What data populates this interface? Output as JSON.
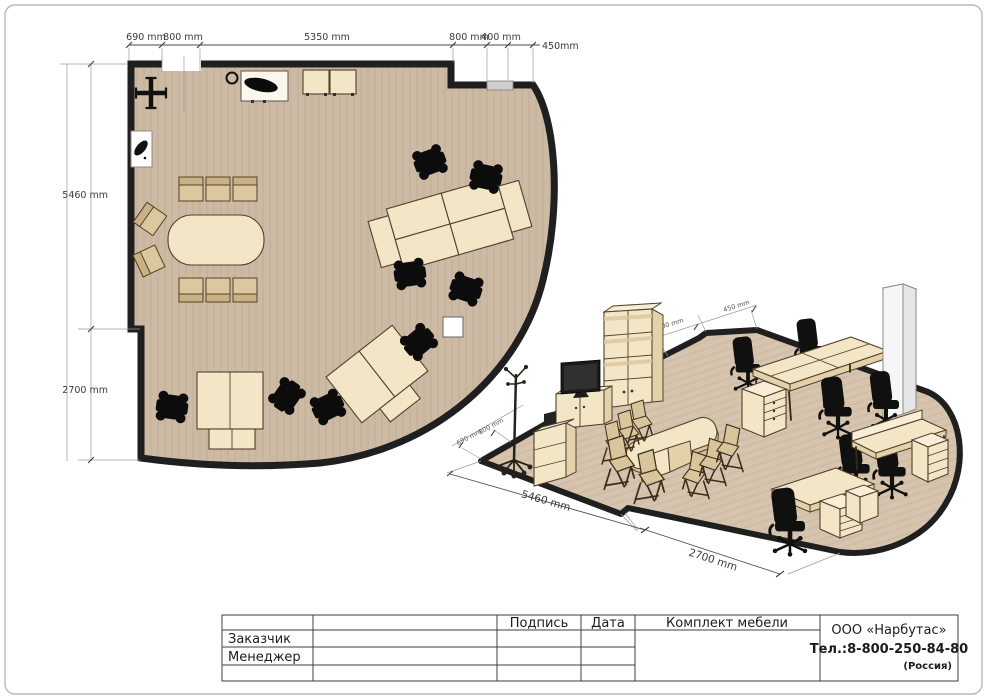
{
  "plan2d": {
    "dims_top": [
      "690 mm",
      "800 mm",
      "5350 mm",
      "800 mm",
      "400 mm",
      "450mm"
    ],
    "dim_left_top": "5460 mm",
    "dim_left_bottom": "2700 mm"
  },
  "view3d": {
    "dim_bottom_left": "5460 mm",
    "dim_bottom_right": "2700 mm",
    "dims_small_top": [
      "800 mm",
      "400 mm",
      "450 mm"
    ],
    "dims_small_left": [
      "690 mm",
      "800 mm"
    ]
  },
  "title_block": {
    "row_labels": [
      "Заказчик",
      "Менеджер"
    ],
    "col_signature": "Подпись",
    "col_date": "Дата",
    "col_set": "Комплект мебели",
    "company_name": "ООО «Нарбутас»",
    "company_phone": "Тел.:8-800-250-84-80",
    "company_country": "(Россия)"
  },
  "colors": {
    "floor": "#cdbaa4",
    "floor3d": "#d6c4ae",
    "wall": "#1f1f1f",
    "furniture_cream": "#f3e6c7",
    "chair_black": "#0f0f0f",
    "page_border": "#b9b9b9"
  }
}
